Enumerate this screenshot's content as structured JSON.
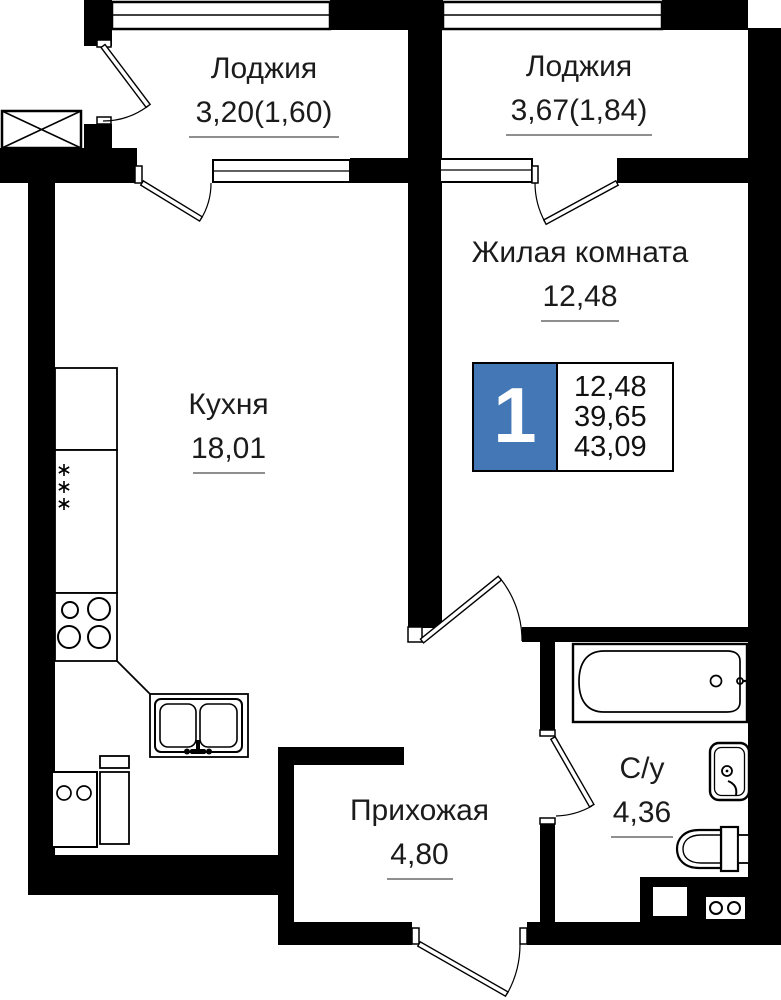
{
  "floor_plan": {
    "rooms": {
      "loggia1": {
        "name": "Лоджия",
        "area": "3,20(1,60)"
      },
      "loggia2": {
        "name": "Лоджия",
        "area": "3,67(1,84)"
      },
      "living_room": {
        "name": "Жилая комната",
        "area": "12,48"
      },
      "kitchen": {
        "name": "Кухня",
        "area": "18,01"
      },
      "hallway": {
        "name": "Прихожая",
        "area": "4,80"
      },
      "bathroom": {
        "name": "С/у",
        "area": "4,36"
      }
    },
    "badge": {
      "rooms_count": "1",
      "living_area": "12,48",
      "area_without_loggia": "39,65",
      "total_area": "43,09"
    },
    "colors": {
      "walls": "#000000",
      "badge_accent": "#4377b5",
      "area_underline": "#8f8f8f",
      "text": "#1b1b1b"
    },
    "fixtures": [
      "vent-shaft-icon",
      "fridge-snowflakes-icon",
      "stove-burners-icon",
      "kitchen-sink-icon",
      "washing-machine-icon",
      "kitchen-cabinet-icon",
      "bathtub-icon",
      "washbasin-icon",
      "toilet-icon",
      "appliance-box-icon"
    ]
  }
}
